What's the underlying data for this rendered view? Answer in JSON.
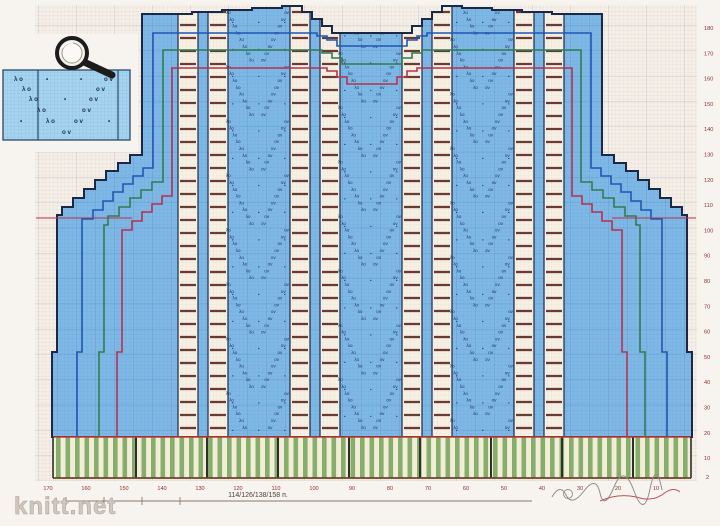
{
  "page": {
    "watermark": "knitt.net"
  },
  "chart": {
    "title_hint": "knitting pattern chart",
    "annotation_stitches": "114/126/138/158 п.",
    "right_axis": [
      "180",
      "170",
      "160",
      "150",
      "140",
      "130",
      "120",
      "110",
      "100",
      "90",
      "80",
      "70",
      "60",
      "50",
      "40",
      "30",
      "20",
      "10"
    ],
    "right_axis_last": "2",
    "bottom_axis": [
      "170",
      "160",
      "150",
      "140",
      "130",
      "120",
      "110",
      "100",
      "90",
      "80",
      "70",
      "60",
      "50",
      "40",
      "30",
      "20",
      "10"
    ],
    "lace_glyphs": {
      "left": "λο",
      "right": "οv",
      "dot": "•"
    },
    "legend_symbols": [
      {
        "x": 14,
        "y": 81,
        "t": "λ ο"
      },
      {
        "x": 46,
        "y": 81,
        "t": "•"
      },
      {
        "x": 80,
        "y": 81,
        "t": "•"
      },
      {
        "x": 104,
        "y": 81,
        "t": "ο v"
      },
      {
        "x": 22,
        "y": 91,
        "t": "λ ο"
      },
      {
        "x": 96,
        "y": 91,
        "t": "ο v"
      },
      {
        "x": 29,
        "y": 101,
        "t": "λ ο"
      },
      {
        "x": 64,
        "y": 101,
        "t": "•"
      },
      {
        "x": 89,
        "y": 101,
        "t": "ο v"
      },
      {
        "x": 37,
        "y": 112,
        "t": "λ ο"
      },
      {
        "x": 82,
        "y": 112,
        "t": "ο v"
      },
      {
        "x": 20,
        "y": 123,
        "t": "•"
      },
      {
        "x": 46,
        "y": 123,
        "t": "λ ο"
      },
      {
        "x": 74,
        "y": 123,
        "t": "ο v"
      },
      {
        "x": 108,
        "y": 123,
        "t": "•"
      },
      {
        "x": 62,
        "y": 134,
        "t": "ο v"
      }
    ],
    "colors": {
      "paper": "#f5efe8",
      "grid_fine": "#d7d2c9",
      "grid_major": "#b9bdc9",
      "body_blue": "#7fb8e5",
      "blue_grid_fine": "#6aa7d9",
      "blue_grid_major": "#5c96c8",
      "ladder_cream": "#f7f1e4",
      "ladder_grid": "#e7dccb",
      "ladder_bar": "#6a3a33",
      "panel_border": "#25365c",
      "outline_size1": "#1a2745",
      "outline_size2": "#1f56b5",
      "outline_size3": "#2f7d52",
      "outline_size4": "#b8304f",
      "ribbing_green": "#85ae6b",
      "ribbing_cream": "#f3ecd9",
      "ribbing_divider": "#2e2e2e",
      "ribbing_topline": "#c13b36",
      "ribbing_bottomline": "#6e4529",
      "axis_text": "#8c3030",
      "watermark_text": "#cfc7bd",
      "legend_base": "#a6d4ef",
      "legend_grid": "#7fb7d8",
      "legend_border": "#2c4a6e"
    }
  }
}
